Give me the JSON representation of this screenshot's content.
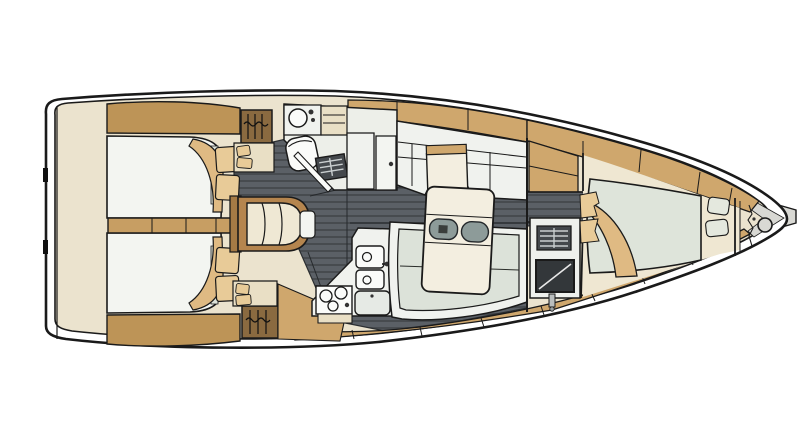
{
  "meta": {
    "title": "Sailing yacht interior layout plan",
    "type": "floor-plan",
    "view": "top-down",
    "orientation": {
      "bow": "right",
      "stern": "left"
    }
  },
  "colors": {
    "outline": "#1a1a1a",
    "hull_white": "#ffffff",
    "interior_beige": "#ebe3ce",
    "sole_dark": "#5b6066",
    "sole_stripe": "#474b4f",
    "teak_band": "#cfa76d",
    "aft_band": "#bd9457",
    "locker_brown": "#8a6a40",
    "frame_brown": "#b5854e",
    "wall_brown": "#a57a45",
    "divider_tan": "#c79e63",
    "mattress_white": "#f3f5f1",
    "cushion_green": "#dce2d9",
    "fwd_mattress_green": "#dee4da",
    "pillow_tan": "#e8cb98",
    "blanket_tan": "#dfba83",
    "table_cream": "#f3eee0",
    "step_cream": "#efe8d4",
    "counter_white": "#f0f2ee",
    "fixture_white": "#fafbf9",
    "shelf_beige": "#e9dfc5",
    "grate_dark": "#44484c",
    "grate_slat": "#c9cecf",
    "tray_gray": "#8d9b99",
    "screen_dark": "#33373a",
    "metal_gray": "#d9d9d4",
    "tip_shade": "#d8d8d3"
  },
  "components": {
    "hull": "hull and deck rim",
    "transom": "transom / swim platform",
    "aft_cabin_top": "aft double cabin (port of companionway)",
    "aft_cabin_bottom": "aft double cabin (starboard of companionway)",
    "companionway": "companionway steps",
    "head": "head with wash basin, toilet and shower",
    "galley": "L-galley with twin sinks, stove and icebox",
    "saloon": "saloon with table and settees",
    "nav_unit": "forward bulkhead locker with vent grille and screen",
    "fwd_cabin": "forward owner cabin with island berth",
    "anchor_locker": "anchor locker with windlass",
    "bow_fitting": "bow anchor roller"
  }
}
